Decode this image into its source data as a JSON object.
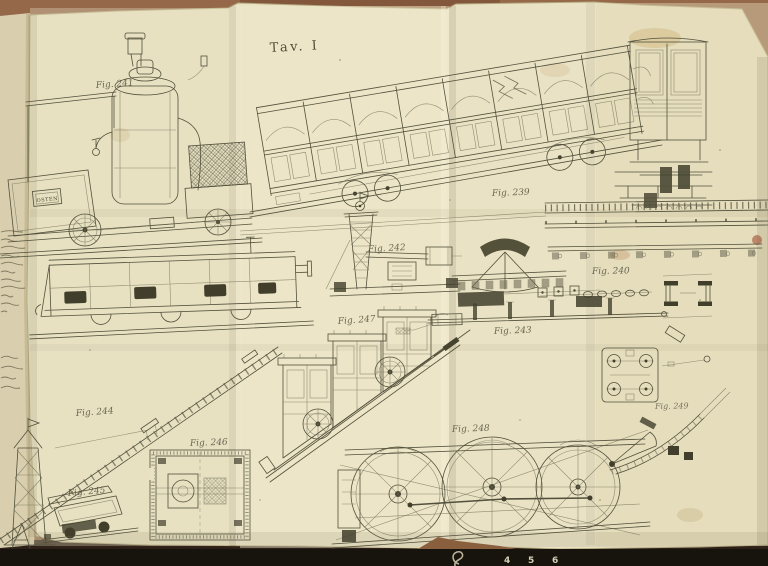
{
  "plate_title": "Tav. I",
  "nameplate": "OSTEN",
  "figures": {
    "f239": "Fig. 239",
    "f240": "Fig. 240",
    "f241": "Fig. 241",
    "f242": "Fig. 242",
    "f243": "Fig. 243",
    "f244": "Fig. 244",
    "f245": "Fig. 245",
    "f246": "Fig. 246",
    "f247": "Fig. 247",
    "f248": "Fig. 248",
    "f249": "Fig. 249"
  },
  "ruler_marks": [
    "4",
    "5",
    "6"
  ],
  "colors": {
    "paper": "#e9e2c4",
    "ink": "#52503c",
    "table_wood": "#96684a",
    "scanner_bed": "#17140e",
    "label_ink": "#5b5946"
  }
}
